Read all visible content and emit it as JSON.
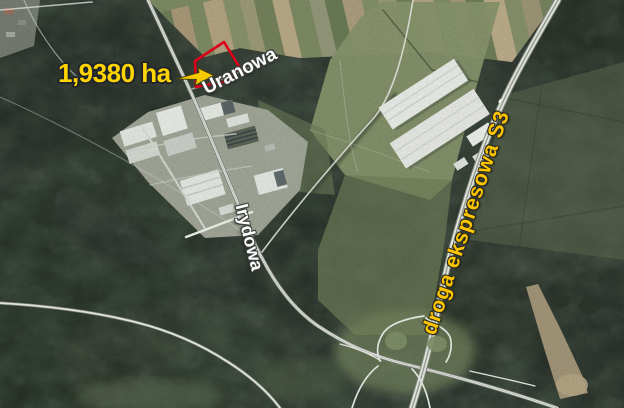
{
  "map": {
    "kind": "aerial-orthophoto-annotation",
    "labels": {
      "area": "1,9380 ha",
      "uranowa": "Uranowa",
      "irydowa": "Irydowa",
      "expressway": "droga ekspresowa S3"
    },
    "colors": {
      "annotation_yellow": "#ffd400",
      "expressway_label_yellow": "#fdc500",
      "parcel_outline_red": "#e50019",
      "street_label_white": "#ffffff"
    },
    "icons": {
      "arrow": "area-arrow-icon pointing to outlined parcel"
    }
  }
}
